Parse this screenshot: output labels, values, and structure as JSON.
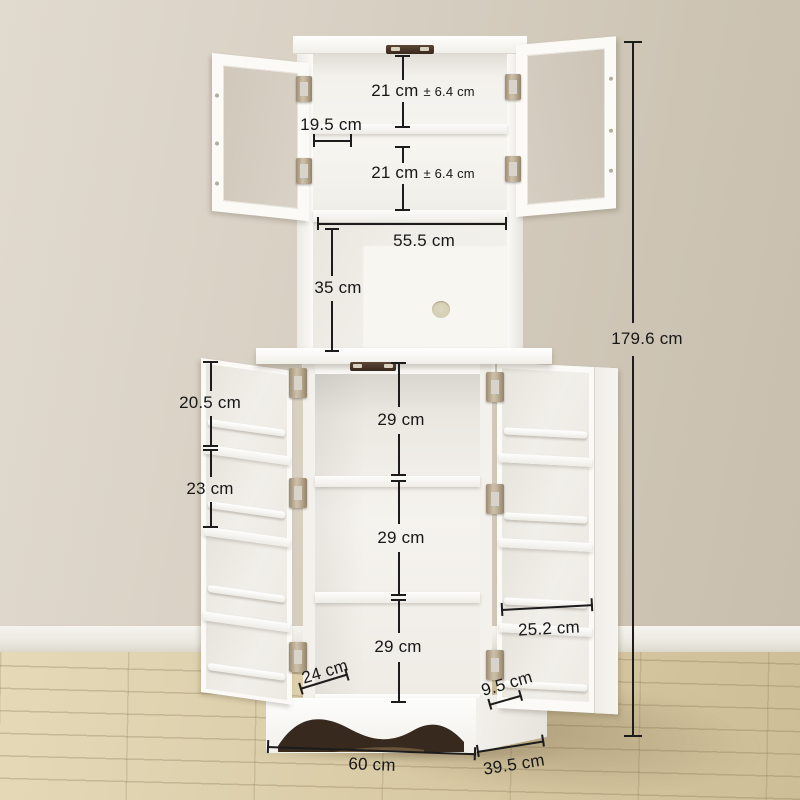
{
  "scene": {
    "title": "Kitchen buffet hutch cabinet dimension diagram",
    "product": "White freestanding storage cabinet with open glass-door hutch, open shelf niche with cable hole, lower cabinet with open doors and door-mounted racks, arched plinth base",
    "setting": "beige wall, white baseboard, light wood plank floor"
  },
  "unit": "cm",
  "colors": {
    "wall": "#d6cec0",
    "baseboard": "#f0eee8",
    "floor_wood": "#d8caa6",
    "cabinet_white": "#fbfaf7",
    "hinge_bronze": "#b4a288",
    "catch_brown": "#453226",
    "dimension_line": "#1c1c1c",
    "cable_hole": "#d6d2be"
  },
  "annotations": {
    "upper_shelf_a": {
      "main": "21 cm",
      "tol": "± 6.4 cm"
    },
    "upper_door_width": {
      "main": "19.5 cm"
    },
    "upper_shelf_b": {
      "main": "21 cm",
      "tol": "± 6.4 cm"
    },
    "hutch_inner_width": {
      "main": "55.5 cm"
    },
    "open_shelf_height": {
      "main": "35 cm"
    },
    "overall_height": {
      "main": "179.6 cm"
    },
    "door_rack_gap_a": {
      "main": "20.5 cm"
    },
    "door_rack_gap_b": {
      "main": "23 cm"
    },
    "lower_shelf_a": {
      "main": "29 cm"
    },
    "lower_shelf_b": {
      "main": "29 cm"
    },
    "lower_shelf_c": {
      "main": "29 cm"
    },
    "door_rack_width": {
      "main": "25.2 cm"
    },
    "lower_door_width": {
      "main": "24 cm"
    },
    "door_rack_depth": {
      "main": "9.5 cm"
    },
    "overall_width": {
      "main": "60 cm"
    },
    "overall_depth": {
      "main": "39.5 cm"
    }
  }
}
